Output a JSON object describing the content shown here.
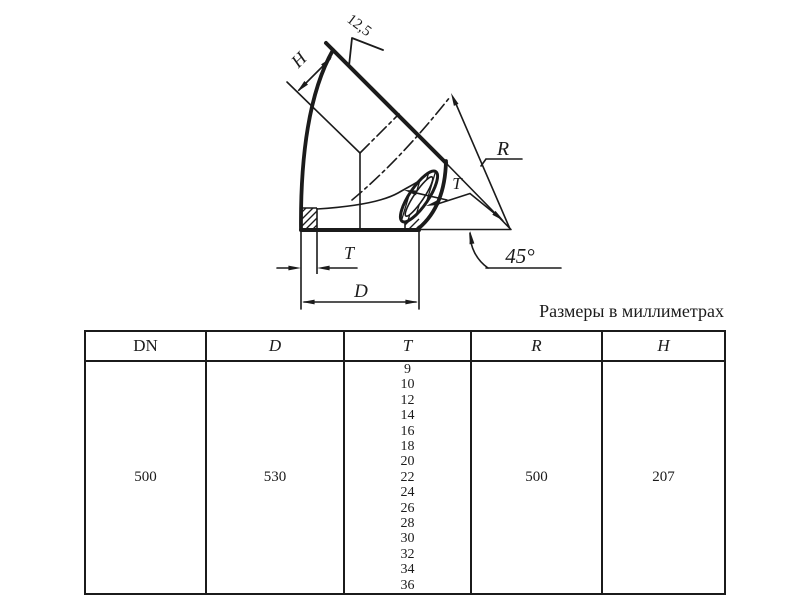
{
  "note": "Размеры в миллиметрах",
  "drawing": {
    "labels": {
      "height": "H",
      "roughness": "12,5",
      "radius": "R",
      "thickness_end": "T",
      "thickness_bottom": "T",
      "diameter": "D",
      "angle": "45°"
    }
  },
  "table": {
    "headers": [
      "DN",
      "D",
      "T",
      "R",
      "H"
    ],
    "row": {
      "dn": "500",
      "d": "530",
      "t_values": [
        "9",
        "10",
        "12",
        "14",
        "16",
        "18",
        "20",
        "22",
        "24",
        "26",
        "28",
        "30",
        "32",
        "34",
        "36"
      ],
      "r": "500",
      "h": "207"
    }
  },
  "colors": {
    "ink": "#1b1b1b",
    "paper": "#ffffff"
  }
}
